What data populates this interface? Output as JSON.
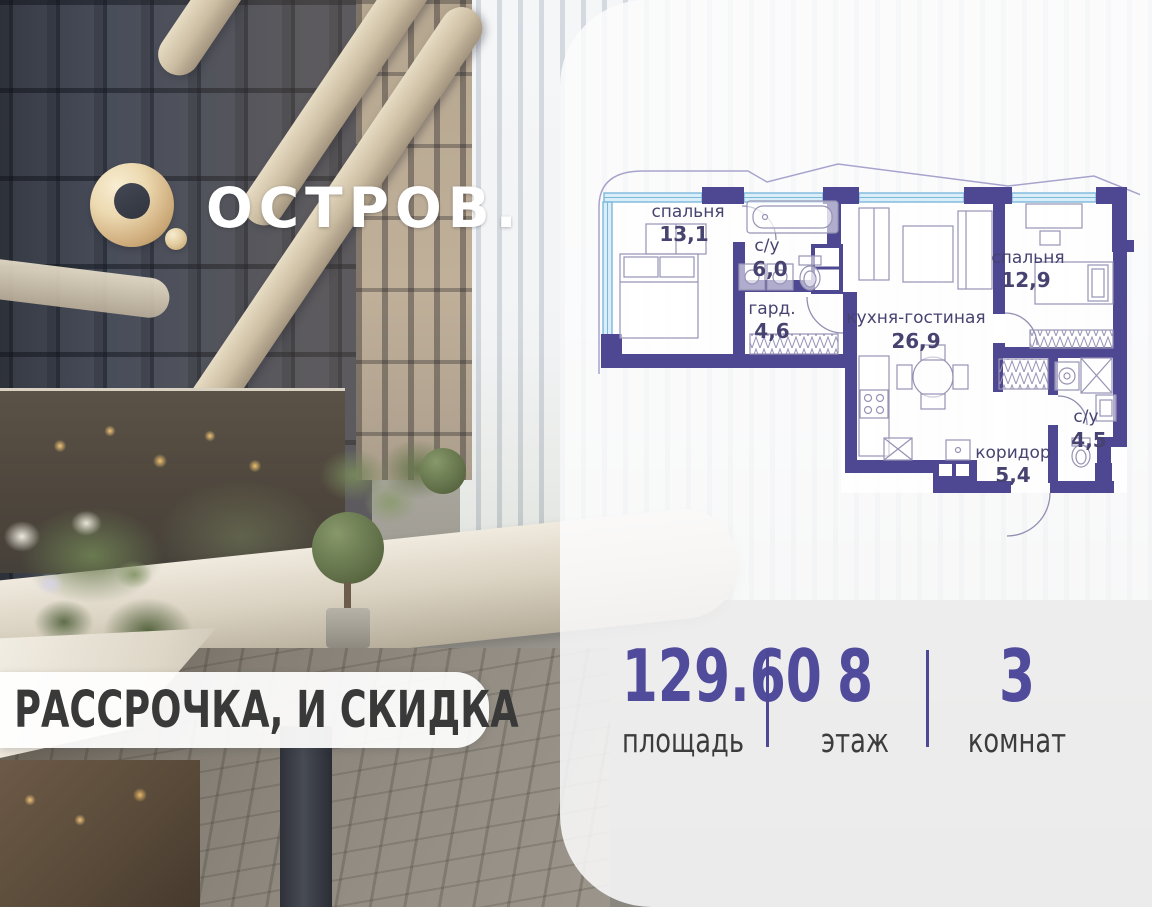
{
  "brand": {
    "name": "ОСТРОВ."
  },
  "banner": {
    "text": "И РАССРОЧКА, И СКИДКА"
  },
  "floorplan": {
    "rooms": [
      {
        "name": "спальня",
        "area": "13,1"
      },
      {
        "name": "с/у",
        "area": "6,0"
      },
      {
        "name": "гард.",
        "area": "4,6"
      },
      {
        "name": "кухня-гостиная",
        "area": "26,9"
      },
      {
        "name": "спальня",
        "area": "12,9"
      },
      {
        "name": "с/у",
        "area": "4,5"
      },
      {
        "name": "коридор",
        "area": "5,4"
      }
    ],
    "colors": {
      "wall": "#4e4791",
      "window_stroke": "#7cb8da",
      "window_fill": "#d9eef9",
      "label": "#474370",
      "furniture": "#9793b4",
      "outline": "#a7a3cd"
    }
  },
  "stats": {
    "items": [
      {
        "value": "129.60",
        "label": "площадь"
      },
      {
        "value": "8",
        "label": "этаж"
      },
      {
        "value": "3",
        "label": "комнат"
      }
    ],
    "accent_color": "#514b9b",
    "label_color": "#3c3c3c"
  },
  "logo_colors": {
    "gold": "#d0ae7e",
    "text": "#ffffff"
  }
}
